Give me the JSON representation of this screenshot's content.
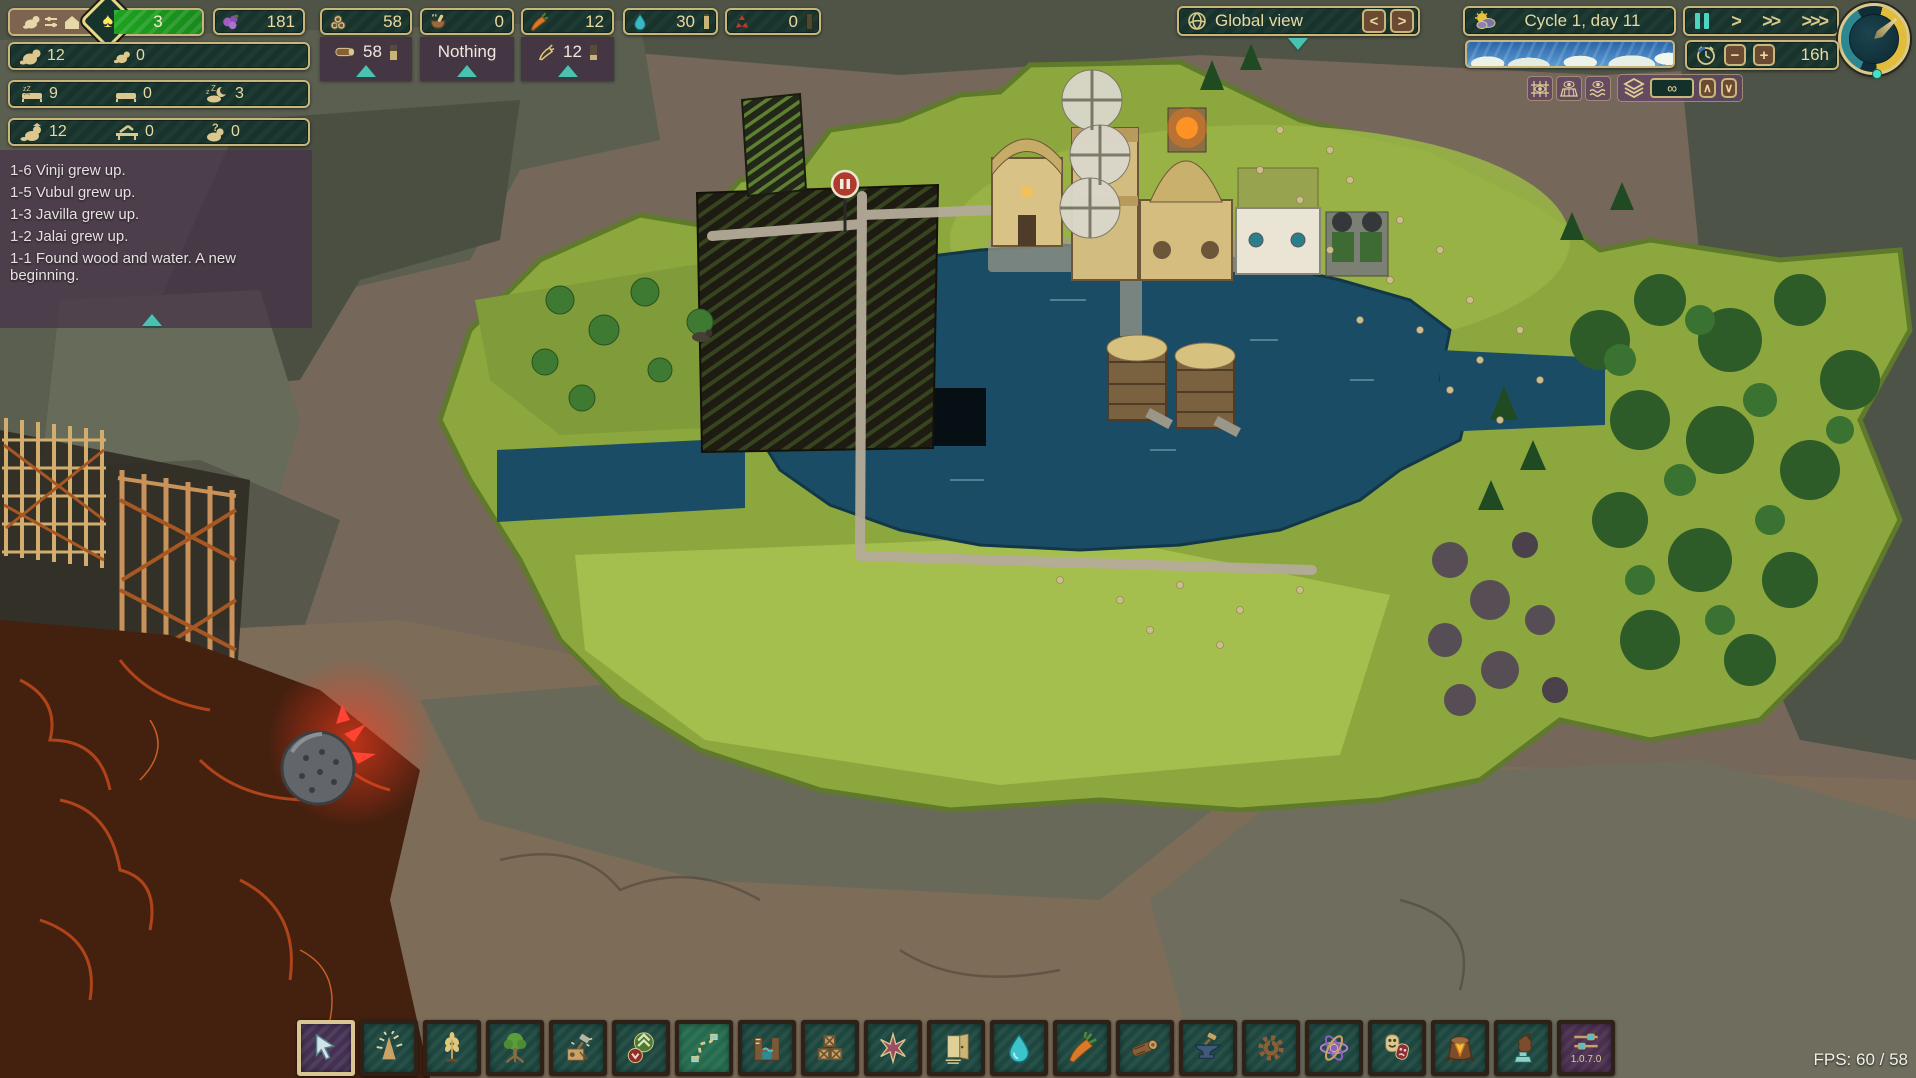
{
  "colors": {
    "hud_panel_bg": "#17332c",
    "hud_border": "#c8b67a",
    "hud_text": "#e8daa4",
    "accent_teal": "#49c2b1",
    "wellbeing_green": "#1da31f",
    "popup_purple": "rgba(62,44,62,0.8)",
    "toolbar_teal": "#1d473f",
    "toolbar_selected_purple": "#433052",
    "pause_active_teal": "#4fd4c2"
  },
  "top_bar": {
    "district": {
      "icon": "district-beaver-icon",
      "wellbeing_icon_glyph": "♠",
      "wellbeing_score": "3"
    },
    "resources": {
      "science": {
        "icon": "science-icon",
        "value": "181"
      },
      "logs": {
        "icon": "logs-icon",
        "value": "58"
      },
      "food": {
        "icon": "food-icon",
        "value": "0"
      },
      "carrots": {
        "icon": "carrot-icon",
        "value": "12"
      },
      "water": {
        "icon": "water-icon",
        "value": "30"
      },
      "badwater": {
        "icon": "badwater-icon",
        "value": "0"
      }
    },
    "popups": {
      "logs": {
        "value": "58"
      },
      "food": {
        "label": "Nothing"
      },
      "carrots": {
        "value": "12"
      }
    }
  },
  "population": {
    "adults": "12",
    "babies": "0",
    "beds_used": "9",
    "beds_empty": "0",
    "sleeping_outside": "3",
    "employed": "12",
    "open_jobs": "0",
    "unemployed": "0"
  },
  "event_log": {
    "entries": [
      "1-6 Vinji grew up.",
      "1-5 Vubul grew up.",
      "1-3 Javilla grew up.",
      "1-2 Jalai grew up.",
      "1-1 Found wood and water. A new beginning."
    ]
  },
  "view_bar": {
    "label": "Global view",
    "prev_glyph": "<",
    "next_glyph": ">"
  },
  "time_bar": {
    "cycle_label": "Cycle 1, day 11",
    "speed": {
      "play": ">",
      "fast": ">>",
      "fastest": ">>>"
    },
    "timer": {
      "minus": "−",
      "plus": "+",
      "value": "16h"
    }
  },
  "layer_bar": {
    "value": "∞",
    "up_glyph": "∧",
    "down_glyph": "∨"
  },
  "toolbar": {
    "icons": [
      "cursor-select",
      "tree-cutting",
      "crops",
      "forestry",
      "demolition",
      "priority",
      "paths",
      "water-structures",
      "storage",
      "landscaping",
      "housing",
      "water-supply",
      "food-production",
      "wood-production",
      "metal-production",
      "power",
      "science",
      "wellbeing",
      "ruins",
      "monuments",
      "settings-version"
    ],
    "version": "1.0.7.0"
  },
  "status": {
    "fps": "FPS: 60 / 58"
  }
}
